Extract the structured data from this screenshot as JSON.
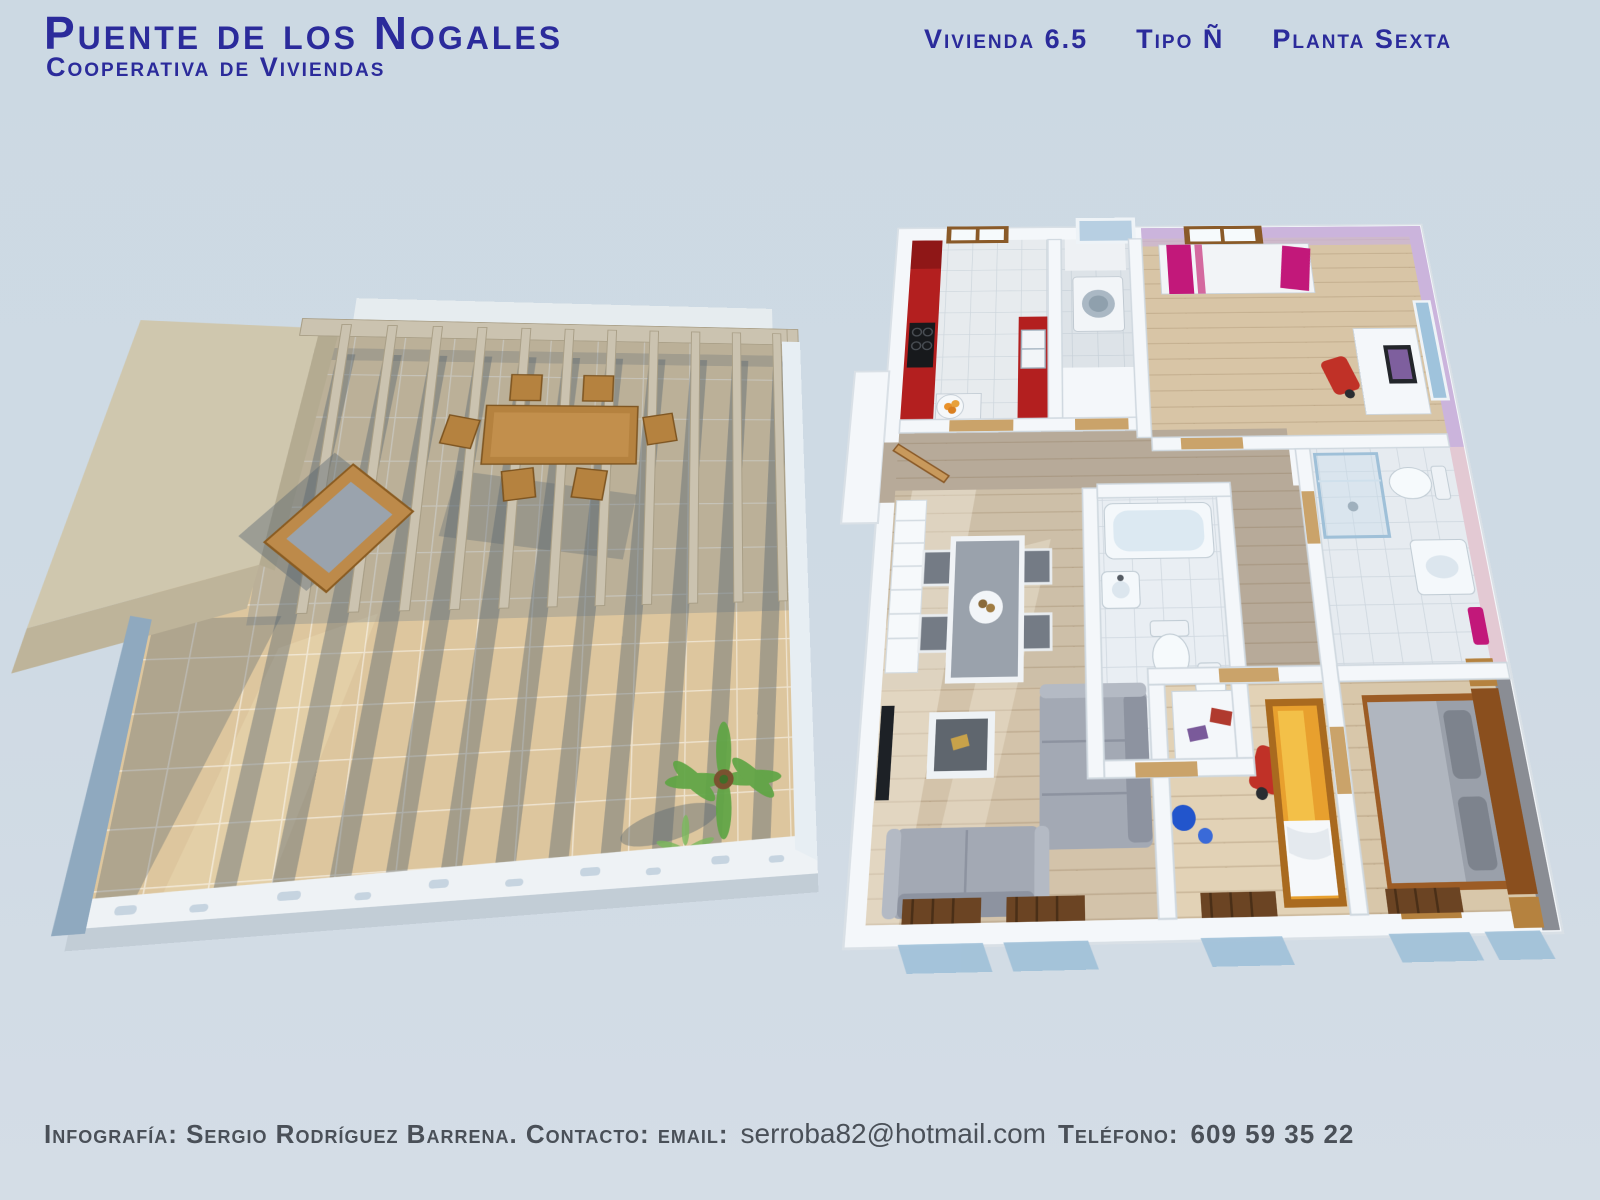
{
  "header": {
    "title": "Puente de los Nogales",
    "subtitle": "Cooperativa de Viviendas",
    "unit": {
      "vivienda": "Vivienda 6.5",
      "tipo": "Tipo Ñ",
      "planta": "Planta Sexta"
    }
  },
  "footer": {
    "credit": "Infografía: Sergio Rodríguez Barrena. Contacto: email:",
    "email": "serroba82@hotmail.com",
    "phone_label": "Teléfono:",
    "phone": "609 59 35 22"
  },
  "colors": {
    "bg": "#ccd9e3",
    "navy": "#2b2b9b",
    "gray": "#4a5058",
    "wall": "#f4f7fa",
    "shadow": "rgba(86,100,112,0.42)",
    "terrace-floor": "#ddc69e",
    "terrace-block": "#cfc7ae",
    "pergola": "#cbc3b0",
    "parapet": "#eef2f5",
    "kitchen-red": "#b31f1f",
    "wood-floor": "#d8c5a6",
    "hall-floor": "#b7aa99",
    "lilac": "#cbb4dc",
    "magenta": "#c2187a",
    "sofa-gray": "#a3a9b4",
    "bed-gray": "#9aa0aa",
    "orange-bed": "#e8a02e",
    "furnwood": "#b5823f",
    "radiator": "#6b4423",
    "glass": "#a9c6dc",
    "dark-wall": "#8a8d94",
    "tv-black": "#1d2126",
    "chair-red": "#c03127",
    "palm": "#5fa544"
  }
}
